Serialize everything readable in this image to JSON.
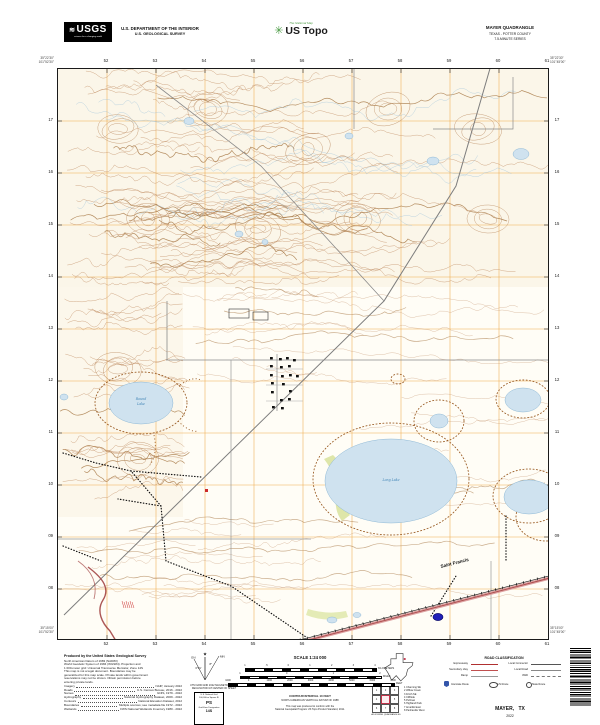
{
  "header": {
    "agency": "USGS",
    "agency_wave": "≋",
    "agency_tagline": "science for a changing world",
    "dept_line1": "U.S. DEPARTMENT OF THE INTERIOR",
    "dept_line2": "U.S. GEOLOGICAL SURVEY",
    "ustopo_tagline": "The National Map",
    "ustopo_pin": "✳",
    "ustopo_brand": "US Topo",
    "quad_title": "MAYER QUADRANGLE",
    "quad_subtitle1": "TEXAS - POTTER COUNTY",
    "quad_subtitle2": "7.5-MINUTE SERIES"
  },
  "map": {
    "grid_labels_top": [
      "52",
      "53",
      "54",
      "55",
      "56",
      "57",
      "58",
      "59",
      "60",
      "61"
    ],
    "grid_labels_bottom": [
      "52",
      "53",
      "54",
      "55",
      "56",
      "57",
      "58",
      "59",
      "60",
      "61"
    ],
    "grid_labels_left": [
      "17",
      "16",
      "15",
      "14",
      "13",
      "12",
      "11",
      "10",
      "09",
      "08"
    ],
    "grid_labels_right": [
      "17",
      "16",
      "15",
      "14",
      "13",
      "12",
      "11",
      "10",
      "09",
      "08"
    ],
    "corners": {
      "nw_lat": "35°22'30\"",
      "nw_lon": "101°52'30\"",
      "ne_lat": "35°22'30\"",
      "ne_lon": "101°45'00\"",
      "sw_lat": "35°15'00\"",
      "sw_lon": "101°52'30\"",
      "se_lat": "35°15'00\"",
      "se_lon": "101°45'00\""
    },
    "labels": {
      "railroad_town": "Saint Francis",
      "lake_nw_1": "Round",
      "lake_nw_2": "Lake",
      "lake_center": "Long Lake"
    },
    "colors": {
      "contour": "#c29068",
      "grid": "#eda33e",
      "water": "#cfe2ef",
      "highway": "#a94a4a",
      "marker": "#2020b8"
    }
  },
  "footer": {
    "produced_by": "Produced by the United States Geological Survey",
    "datum_notes": [
      "North American Datum of 1983 (NAD83)",
      "World Geodetic System of 1984 (WGS84). Projection and",
      "1 000-meter grid: Universal Transverse Mercator, Zone 14S",
      "This map is not a legal document. Boundaries may be",
      "generalized for this map scale. Private lands within government",
      "reservations may not be shown. Obtain permission before",
      "entering private lands."
    ],
    "credits": [
      {
        "label": "Imagery",
        "value": "NAIP, January 2022"
      },
      {
        "label": "Roads",
        "value": "U.S. Census Bureau, 2016 - 2022"
      },
      {
        "label": "Names",
        "value": "GNIS, 1979 - 2022"
      },
      {
        "label": "Hydrography",
        "value": "National Hydrography Dataset, 2009 - 2022"
      },
      {
        "label": "Contours",
        "value": "National Elevation Dataset, 2012"
      },
      {
        "label": "Boundaries",
        "value": "Multiple sources; see metadata file 1972 - 2022"
      },
      {
        "label": "Wetlands",
        "value": "FWS National Wetlands Inventory 1980 - 2022"
      }
    ],
    "scale": {
      "title": "SCALE 1:24 000",
      "km_unit": "KILOMETERS",
      "km_ticks": [
        "1",
        ".5",
        "0",
        "1",
        "2",
        "3",
        "4"
      ],
      "mi_unit": "MILES",
      "mi_ticks": [
        "1",
        "0",
        "1",
        "2"
      ],
      "ft_unit": "FEET",
      "ft_ticks": [
        "1000",
        "0",
        "1000",
        "2000",
        "3000",
        "4000",
        "5000",
        "6000",
        "7000"
      ]
    },
    "contour_line1": "CONTOUR INTERVAL 10 FEET",
    "contour_line2": "NORTH AMERICAN VERTICAL DATUM OF 1988",
    "conform_line1": "This map was produced to conform with the",
    "conform_line2": "National Geospatial Program US Topo Product Standard, 2011.",
    "declination": {
      "star": "★",
      "mn": "MN",
      "gn": "GN",
      "mn_angle": "8°",
      "gn_angle": "0°21'",
      "caption1": "UTM GRID AND 2022 MAGNETIC NORTH",
      "caption2": "DECLINATION AT CENTER OF SHEET"
    },
    "usng": {
      "line1": "U.S. National Grid",
      "line2": "100,000-m Square ID",
      "square": "PS",
      "gzd_label": "Grid Zone Designation",
      "gzd": "14S"
    },
    "road_class": {
      "title": "ROAD CLASSIFICATION",
      "rows_left": [
        "Expressway",
        "Secondary Hwy",
        "Ramp",
        "4WD"
      ],
      "rows_right": [
        "Local Connector",
        "Local Road"
      ],
      "shields": [
        "Interstate Route",
        "US Route",
        "State Route"
      ]
    },
    "adjoining": {
      "caption": "ADJOINING QUADRANGLES",
      "numbers": [
        "1",
        "2",
        "3",
        "4",
        "5",
        "6",
        "7",
        "8"
      ],
      "names": [
        "1 Channing SE",
        "2 Willow Creek",
        "3 Fritch SE",
        "4 Cliffside",
        "5 Pullman",
        "6 Highland Park",
        "7 Amarillo East",
        "8 Panhandle West"
      ]
    },
    "sheet_title": "MAYER, TX",
    "sheet_year": "2022"
  }
}
